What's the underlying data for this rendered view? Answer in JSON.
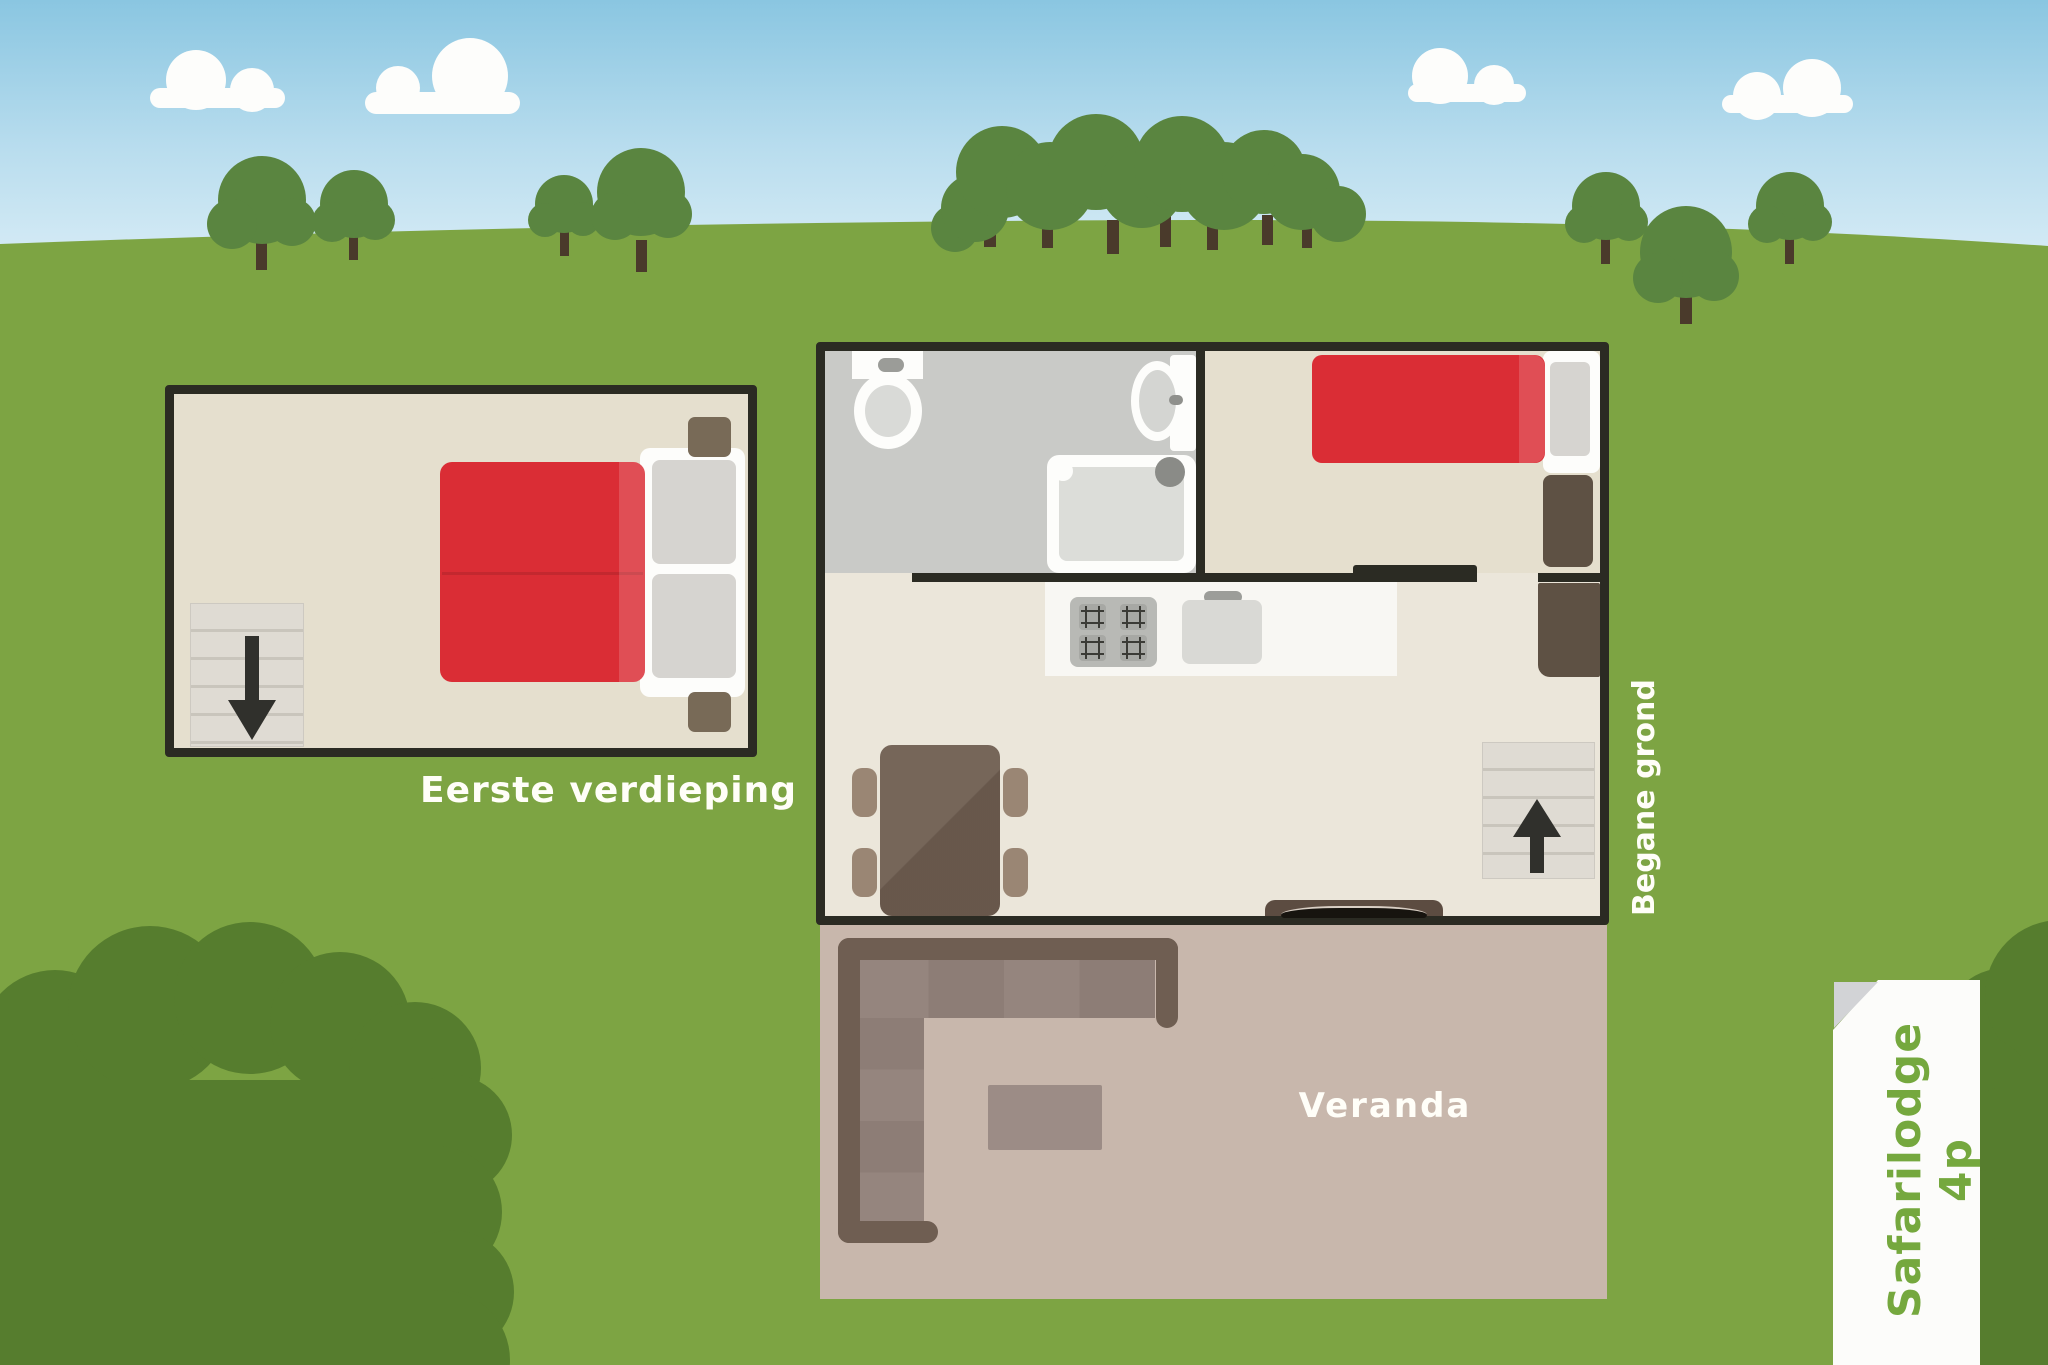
{
  "illustration": {
    "title": "Safarilodge 4p floor plan",
    "sign": {
      "label": "Safarilodge 4p",
      "text_color": "#75a83e",
      "background": "#fcfcfa"
    },
    "floors": {
      "first_floor": {
        "label": "Eerste verdieping",
        "furniture": [
          "double-bed",
          "two-pillows",
          "nightstand-top",
          "nightstand-bottom",
          "stairs-down"
        ]
      },
      "ground_floor": {
        "label": "Begane grond",
        "rooms": {
          "bathroom": [
            "toilet",
            "wash-basin",
            "shower"
          ],
          "bedroom": [
            "single-bed",
            "pillow",
            "wardrobe",
            "sliding-door"
          ],
          "living_kitchen": [
            "stove-4-burners",
            "kitchen-sink",
            "dining-table",
            "four-chairs",
            "wardrobe",
            "stairs-up",
            "barbecue"
          ]
        }
      },
      "veranda": {
        "label": "Veranda",
        "furniture": [
          "corner-sofa",
          "coffee-table"
        ]
      }
    },
    "colors": {
      "grass": "#7da443",
      "bush": "#567d2e",
      "tree_crown": "#5a8540",
      "tree_trunk": "#4a3a2b",
      "sky_top": "#8ac6e1",
      "sky_horizon": "#d3eaf5",
      "wall": "#2b2b23",
      "bed_red": "#da2d35",
      "floor_beige": "#e5dfce",
      "bathroom_gray": "#c9cac7",
      "veranda_floor": "#c8b7ac"
    }
  }
}
